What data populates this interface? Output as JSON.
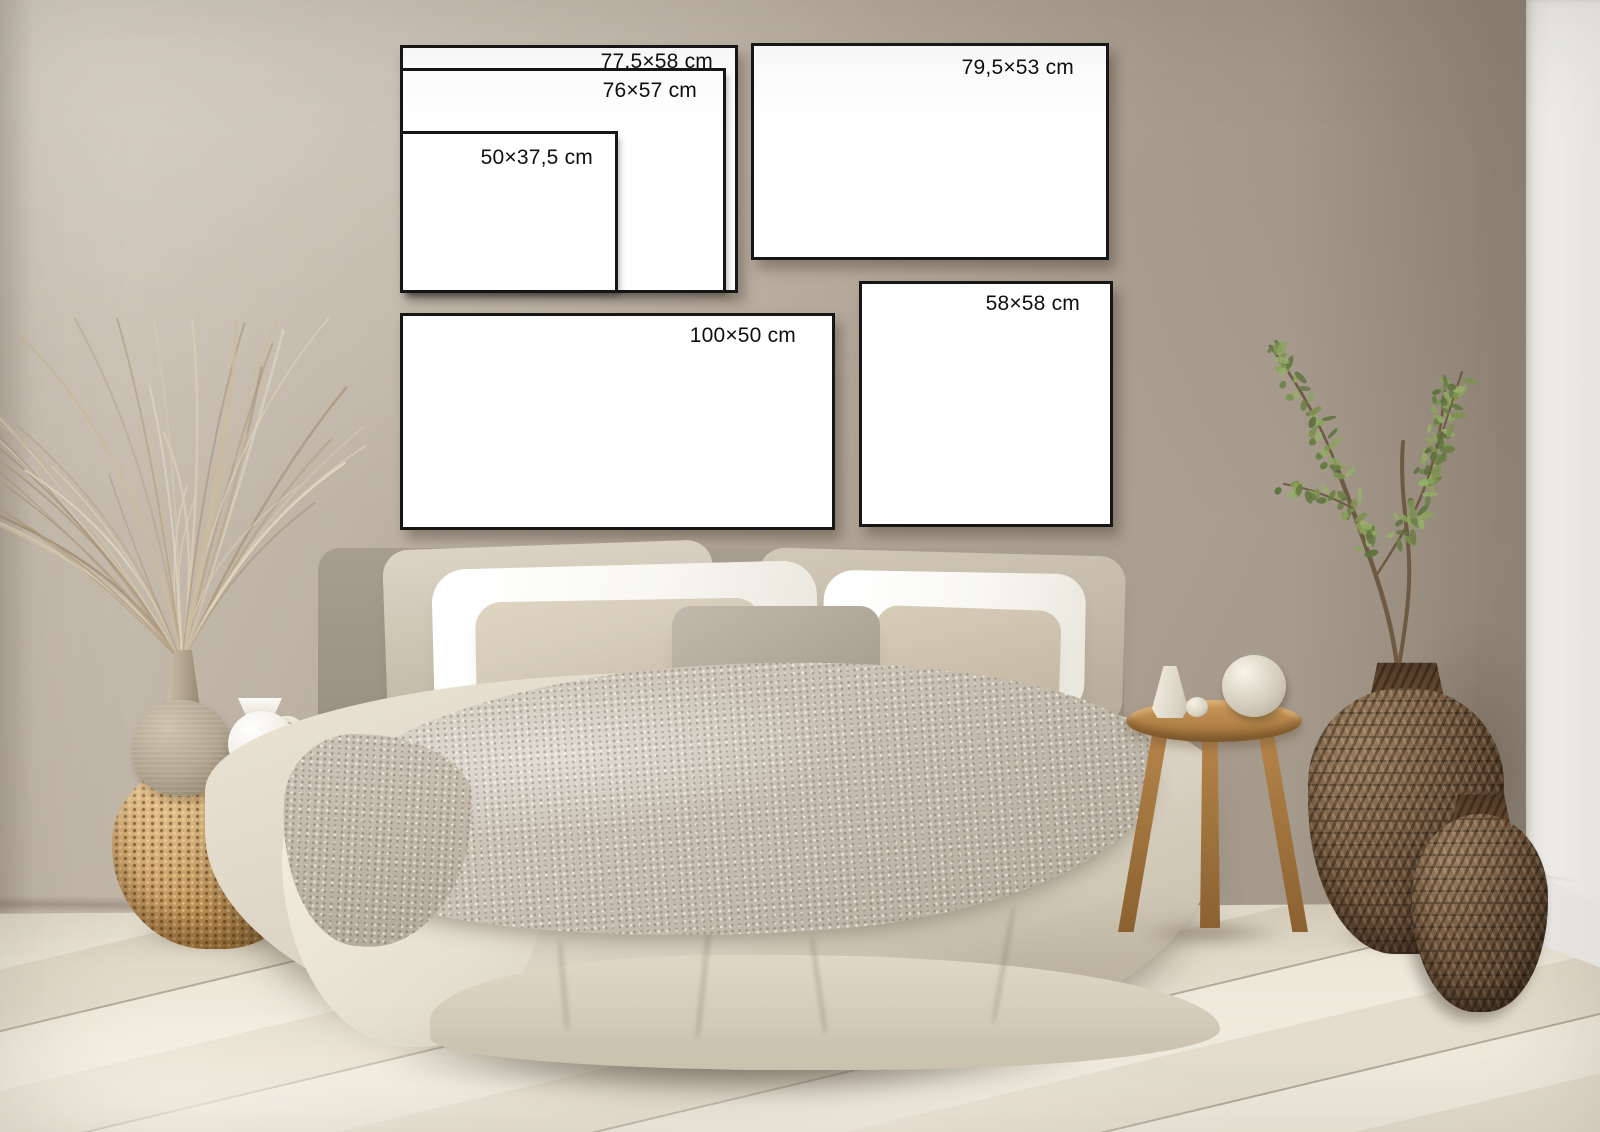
{
  "frames": {
    "nested": [
      {
        "label": "77,5×58 cm"
      },
      {
        "label": "76×57 cm"
      },
      {
        "label": "50×37,5 cm"
      }
    ],
    "top_right": {
      "label": "79,5×53 cm"
    },
    "bottom_wide": {
      "label": "100×50 cm"
    },
    "bottom_square": {
      "label": "58×58 cm"
    }
  },
  "colors": {
    "wall": "#b4a89a",
    "wall_light": "#cfc7b9",
    "wall_dark": "#9e9284",
    "white_panel": "#f4f3f0",
    "floor": "#e9e2d1",
    "frame_border": "#161616",
    "frame_fill": "#ffffff",
    "label_text": "#0f0f0f",
    "duvet": "#d8d0c0",
    "duvet_light": "#ece6d8",
    "duvet_dark": "#c2b8a5",
    "throw": "#c9c1b4",
    "pillow_white": "#f8f7f2",
    "pillow_beige": "#d6ccba",
    "cushion": "#b3a99b",
    "headboard": "#a79d90",
    "wicker": "#c59a5e",
    "wood": "#b5844a",
    "wood_dark": "#8a6130",
    "ceramic_white": "#f3f0e8",
    "ceramic_beige": "#b2a692",
    "basket": "#74573d",
    "basket_dark": "#4a3523",
    "leaf_green": "#7f9454",
    "branch": "#6e5a42"
  }
}
